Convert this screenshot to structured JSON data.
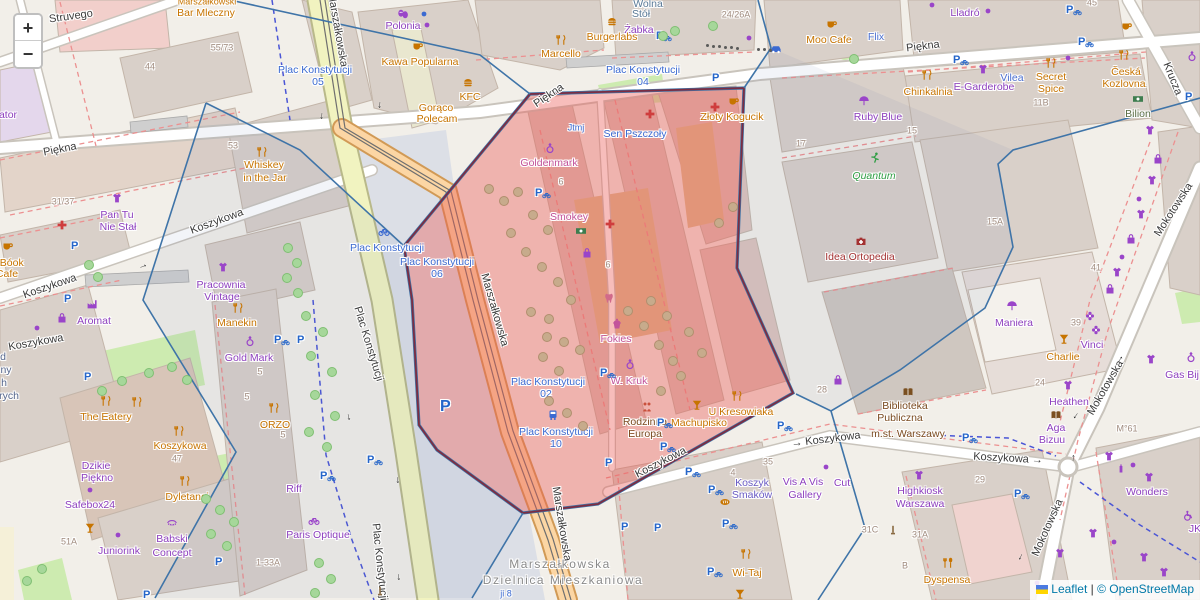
{
  "controls": {
    "zoom_in": "+",
    "zoom_out": "−"
  },
  "attribution": {
    "leaflet": "Leaflet",
    "separator": " | ",
    "osm": "© OpenStreetMap"
  },
  "colors": {
    "overlay": "#ea5a56",
    "overlay_border": "#7c2d42",
    "boundary": "#3f74a8",
    "parking_blue": "#2565c9",
    "poi_orange": "#c77400",
    "poi_purple": "#9a45c9",
    "transit_blue": "#3b6ad1",
    "link_blue": "#0078A8"
  },
  "district": [
    [
      "Marszałkowska",
      560,
      564
    ],
    [
      "Dzielnica Mieszkaniowa",
      563,
      580
    ]
  ],
  "streets": [
    [
      "Struvego",
      71,
      17,
      -8
    ],
    [
      "Piękna",
      60,
      150,
      -11
    ],
    [
      "Piękna",
      549,
      96,
      -34
    ],
    [
      "Piękna",
      923,
      47,
      -7
    ],
    [
      "Marszałkowska",
      337,
      30,
      80
    ],
    [
      "Marszałkowska",
      494,
      310,
      74
    ],
    [
      "Marszałkowska",
      561,
      524,
      81
    ],
    [
      "Plac Konstytucji",
      368,
      344,
      73
    ],
    [
      "Plac Konstytucji",
      379,
      562,
      84
    ],
    [
      "Koszykowa",
      50,
      287,
      -19
    ],
    [
      "Koszykowa",
      217,
      222,
      -20
    ],
    [
      "Koszykowa",
      36,
      343,
      -10
    ],
    [
      "Koszykowa",
      661,
      463,
      -27
    ],
    [
      "→ Koszykowa",
      826,
      440,
      -7
    ],
    [
      "Koszykowa →",
      1008,
      459,
      3
    ],
    [
      "Mokotowska",
      1174,
      210,
      -57
    ],
    [
      "Mokotowska",
      1106,
      388,
      -60
    ],
    [
      "Mokotowska",
      1048,
      528,
      -66
    ],
    [
      "Krucza",
      1172,
      79,
      68
    ]
  ],
  "transit": [
    [
      "Plac Konstytucji",
      315,
      70
    ],
    [
      "05",
      318,
      82
    ],
    [
      "Plac Konstytucji",
      643,
      70
    ],
    [
      "04",
      643,
      82
    ],
    [
      "Plac Konstytucji",
      387,
      248
    ],
    [
      "Plac Konstytucji",
      437,
      262
    ],
    [
      "06",
      437,
      274
    ],
    [
      "Plac Konstytucji",
      548,
      382
    ],
    [
      "02",
      546,
      394
    ],
    [
      "Plac Konstytucji",
      556,
      432
    ],
    [
      "10",
      556,
      444
    ],
    [
      "Sen Pszczoły",
      635,
      134
    ],
    [
      "Jtmj",
      576,
      128,
      9
    ],
    [
      "ji 8",
      506,
      594,
      9
    ]
  ],
  "pois": [
    [
      "Marszałkowski",
      207,
      2,
      "o",
      9
    ],
    [
      "Bar Mleczny",
      206,
      13,
      "o"
    ],
    [
      "Polonia",
      403,
      26,
      "p"
    ],
    [
      "Żabka",
      639,
      30,
      "p"
    ],
    [
      "Burgerlabs",
      612,
      37,
      "o"
    ],
    [
      "Wolna",
      648,
      4,
      "bg"
    ],
    [
      "Stół",
      641,
      14,
      "bg"
    ],
    [
      "Kawa Popularna",
      420,
      62,
      "o"
    ],
    [
      "KFC",
      470,
      97,
      "o"
    ],
    [
      "Gorąco",
      436,
      108,
      "o"
    ],
    [
      "Polecam",
      437,
      119,
      "o"
    ],
    [
      "Marcello",
      561,
      54,
      "o"
    ],
    [
      "Moo Cafe",
      829,
      40,
      "o"
    ],
    [
      "Flix",
      876,
      37,
      "b"
    ],
    [
      "Lladró",
      965,
      13,
      "p"
    ],
    [
      "Ruby Blue",
      878,
      117,
      "p"
    ],
    [
      "Chinkalnia",
      928,
      92,
      "o"
    ],
    [
      "E-Garderobe",
      984,
      87,
      "p"
    ],
    [
      "Vilea",
      1012,
      78,
      "b"
    ],
    [
      "Secret",
      1051,
      77,
      "o"
    ],
    [
      "Spice",
      1051,
      89,
      "o"
    ],
    [
      "Česká",
      1126,
      72,
      "o"
    ],
    [
      "Kozlovna",
      1124,
      84,
      "o"
    ],
    [
      "Bilion",
      1138,
      114,
      "ol"
    ],
    [
      "Whiskey",
      264,
      165,
      "o"
    ],
    [
      "in the Jar",
      265,
      178,
      "o"
    ],
    [
      "Pan Tu",
      117,
      215,
      "p"
    ],
    [
      "Nie Stał",
      118,
      227,
      "p"
    ],
    [
      "Pracownia",
      221,
      285,
      "p"
    ],
    [
      "Vintage",
      222,
      297,
      "p"
    ],
    [
      "-Bóok",
      10,
      263,
      "o"
    ],
    [
      "Cafe",
      7,
      274,
      "o"
    ],
    [
      "Aromat",
      94,
      321,
      "p"
    ],
    [
      "Manekin",
      237,
      323,
      "o"
    ],
    [
      "Gold Mark",
      249,
      358,
      "p"
    ],
    [
      "ORZO",
      275,
      425,
      "o"
    ],
    [
      "The Eatery",
      106,
      417,
      "o"
    ],
    [
      "Koszykowa",
      180,
      446,
      "o"
    ],
    [
      "Dzikie",
      96,
      466,
      "p"
    ],
    [
      "Piękno",
      97,
      478,
      "p"
    ],
    [
      "Safebox24",
      90,
      505,
      "p"
    ],
    [
      "Dyletanci",
      187,
      497,
      "o"
    ],
    [
      "Babski",
      172,
      539,
      "p"
    ],
    [
      "Concept",
      172,
      553,
      "p"
    ],
    [
      "Juniorink",
      119,
      551,
      "p"
    ],
    [
      "Riff",
      294,
      489,
      "p"
    ],
    [
      "Paris Optique",
      318,
      535,
      "p"
    ],
    [
      "Goldenmark",
      549,
      163,
      "k"
    ],
    [
      "Smokey",
      569,
      217,
      "k"
    ],
    [
      "Złoty Kogucik",
      732,
      117,
      "o"
    ],
    [
      "Fokies",
      616,
      339,
      "k"
    ],
    [
      "W. Kruk",
      629,
      381,
      "k"
    ],
    [
      "Rodzinna",
      645,
      422,
      "br"
    ],
    [
      "Europa",
      645,
      434,
      "br"
    ],
    [
      "Machupisko",
      699,
      423,
      "o"
    ],
    [
      "U Kresowiaka",
      741,
      412,
      "o"
    ],
    [
      "Quantum",
      874,
      176,
      "g"
    ],
    [
      "Idea Ortopedia",
      860,
      257,
      "dr"
    ],
    [
      "Maniera",
      1014,
      323,
      "p"
    ],
    [
      "Vinci",
      1092,
      345,
      "p"
    ],
    [
      "Charlie",
      1063,
      357,
      "o"
    ],
    [
      "Heathen",
      1069,
      402,
      "p"
    ],
    [
      "Aga",
      1056,
      428,
      "p"
    ],
    [
      "Bizuu",
      1052,
      440,
      "p"
    ],
    [
      "Gas Bij",
      1182,
      375,
      "p"
    ],
    [
      "Biblioteka",
      905,
      406,
      "br"
    ],
    [
      "Publiczna",
      900,
      418,
      "br"
    ],
    [
      "m.st. Warszawy",
      908,
      434,
      "br"
    ],
    [
      "Highkiosk",
      920,
      491,
      "p"
    ],
    [
      "Warszawa",
      920,
      504,
      "p"
    ],
    [
      "Wonders",
      1147,
      492,
      "p"
    ],
    [
      "Dyspensa",
      947,
      580,
      "o"
    ],
    [
      "Wi-Taj",
      747,
      573,
      "o"
    ],
    [
      "Koszyk",
      752,
      483,
      "vb"
    ],
    [
      "Smaków",
      752,
      495,
      "vb"
    ],
    [
      "Vis A Vis",
      803,
      482,
      "p"
    ],
    [
      "Gallery",
      805,
      495,
      "p"
    ],
    [
      "Cut",
      842,
      483,
      "p"
    ],
    [
      "ator",
      8,
      115,
      "p"
    ],
    [
      "d",
      3,
      357,
      "b2"
    ],
    [
      "ny",
      6,
      370,
      "b2"
    ],
    [
      "h",
      4,
      383,
      "b2"
    ],
    [
      "rych",
      9,
      396,
      "b2"
    ],
    [
      "JK",
      1195,
      529,
      "p"
    ]
  ],
  "housenumbers": [
    [
      "44",
      150,
      67
    ],
    [
      "55/73",
      222,
      48
    ],
    [
      "53",
      233,
      146
    ],
    [
      "31/37",
      63,
      202
    ],
    [
      "24/26A",
      736,
      15
    ],
    [
      "17",
      801,
      144
    ],
    [
      "15",
      912,
      131
    ],
    [
      "11B",
      1041,
      103
    ],
    [
      "15A",
      995,
      222
    ],
    [
      "41",
      1096,
      268
    ],
    [
      "45",
      1092,
      3
    ],
    [
      "39",
      1076,
      323
    ],
    [
      "24",
      1040,
      383
    ],
    [
      "28",
      822,
      390
    ],
    [
      "6",
      561,
      182
    ],
    [
      "6",
      608,
      265
    ],
    [
      "5",
      260,
      372
    ],
    [
      "5",
      247,
      397
    ],
    [
      "5",
      283,
      435
    ],
    [
      "47",
      177,
      459
    ],
    [
      "51A",
      69,
      542
    ],
    [
      "1-33A",
      268,
      563
    ],
    [
      "29",
      980,
      480
    ],
    [
      "31A",
      920,
      535
    ],
    [
      "31C",
      870,
      530
    ],
    [
      "35",
      768,
      462
    ],
    [
      "4",
      733,
      473
    ],
    [
      "B",
      905,
      566
    ],
    [
      "M°61",
      1127,
      429
    ]
  ],
  "icons": [
    [
      "cup",
      418,
      46
    ],
    [
      "cup",
      8,
      246
    ],
    [
      "cup",
      734,
      101
    ],
    [
      "cup",
      832,
      24
    ],
    [
      "cup",
      1127,
      26
    ],
    [
      "burger",
      612,
      22
    ],
    [
      "burger",
      468,
      83
    ],
    [
      "fork",
      561,
      40
    ],
    [
      "fork",
      262,
      152
    ],
    [
      "fork",
      238,
      308
    ],
    [
      "fork",
      274,
      408
    ],
    [
      "fork",
      106,
      401
    ],
    [
      "fork",
      137,
      402
    ],
    [
      "fork",
      179,
      431
    ],
    [
      "fork",
      185,
      481
    ],
    [
      "fork",
      927,
      75
    ],
    [
      "fork",
      1051,
      63
    ],
    [
      "fork",
      1124,
      55
    ],
    [
      "fork",
      737,
      396
    ],
    [
      "fork",
      746,
      554
    ],
    [
      "forkspoon",
      948,
      563
    ],
    [
      "cocktail",
      90,
      528
    ],
    [
      "cocktail",
      1064,
      339
    ],
    [
      "cocktail",
      697,
      405
    ],
    [
      "cocktail",
      740,
      594
    ],
    [
      "ring",
      250,
      341
    ],
    [
      "ring",
      550,
      148
    ],
    [
      "ring",
      630,
      364
    ],
    [
      "ring",
      1191,
      357
    ],
    [
      "ring",
      1192,
      56
    ],
    [
      "cross",
      62,
      225
    ],
    [
      "cross",
      650,
      114
    ],
    [
      "cross",
      715,
      107
    ],
    [
      "cross",
      610,
      224
    ],
    [
      "case",
      861,
      241
    ],
    [
      "tooth",
      609,
      298
    ],
    [
      "book",
      908,
      392
    ],
    [
      "book",
      1056,
      415
    ],
    [
      "money",
      581,
      231
    ],
    [
      "money",
      1138,
      99
    ],
    [
      "runner",
      875,
      158
    ],
    [
      "people",
      647,
      407
    ],
    [
      "umbrella",
      864,
      101
    ],
    [
      "umbrella",
      1012,
      306
    ],
    [
      "bag",
      62,
      318
    ],
    [
      "bag",
      587,
      253
    ],
    [
      "bag",
      838,
      380
    ],
    [
      "bag",
      1158,
      159
    ],
    [
      "bag",
      1131,
      239
    ],
    [
      "bag",
      1110,
      289
    ],
    [
      "cake",
      617,
      324
    ],
    [
      "masks",
      403,
      14
    ],
    [
      "car",
      776,
      49
    ],
    [
      "tram",
      553,
      415
    ],
    [
      "dot",
      427,
      25
    ],
    [
      "dot",
      932,
      5
    ],
    [
      "dot",
      988,
      11
    ],
    [
      "dot",
      1068,
      58
    ],
    [
      "dot",
      37,
      328
    ],
    [
      "dot",
      118,
      535
    ],
    [
      "dot",
      90,
      490
    ],
    [
      "dot",
      1139,
      199
    ],
    [
      "dot",
      1122,
      257
    ],
    [
      "dot",
      1133,
      465
    ],
    [
      "dot",
      1114,
      542
    ],
    [
      "dot",
      1037,
      583
    ],
    [
      "dot",
      826,
      467
    ],
    [
      "dot",
      749,
      38
    ],
    [
      "dot",
      424,
      14,
      "#3b6ad1"
    ],
    [
      "flower",
      1090,
      316
    ],
    [
      "flower",
      1096,
      330
    ],
    [
      "bottle",
      1121,
      468
    ],
    [
      "wheelchair",
      1188,
      516
    ],
    [
      "factory",
      92,
      304
    ],
    [
      "pole",
      380,
      591
    ],
    [
      "pole",
      893,
      530
    ],
    [
      "bike",
      384,
      231
    ],
    [
      "bike",
      314,
      520,
      "#9a45c9"
    ],
    [
      "bread",
      725,
      502
    ],
    [
      "shirt",
      117,
      198
    ],
    [
      "shirt",
      223,
      267
    ],
    [
      "shirt",
      983,
      69
    ],
    [
      "shirt",
      919,
      475
    ],
    [
      "shirt",
      1068,
      385
    ],
    [
      "shirt",
      1151,
      359
    ],
    [
      "shirt",
      1152,
      180
    ],
    [
      "shirt",
      1141,
      214
    ],
    [
      "shirt",
      1117,
      272
    ],
    [
      "shirt",
      1109,
      456
    ],
    [
      "shirt",
      1149,
      477
    ],
    [
      "shirt",
      1093,
      533
    ],
    [
      "shirt",
      1144,
      557
    ],
    [
      "shirt",
      1164,
      572
    ],
    [
      "shirt",
      1060,
      553
    ],
    [
      "shirt",
      1150,
      130
    ],
    [
      "lash",
      172,
      522
    ]
  ],
  "parking": [
    [
      71,
      246,
      0
    ],
    [
      64,
      299,
      0
    ],
    [
      297,
      340,
      0
    ],
    [
      274,
      340,
      1
    ],
    [
      84,
      377,
      0
    ],
    [
      440,
      404,
      2
    ],
    [
      535,
      193,
      1
    ],
    [
      656,
      36,
      1
    ],
    [
      712,
      78,
      0
    ],
    [
      953,
      60,
      1
    ],
    [
      1066,
      10,
      1
    ],
    [
      1078,
      42,
      1
    ],
    [
      1185,
      97,
      0
    ],
    [
      600,
      373,
      1
    ],
    [
      657,
      423,
      1
    ],
    [
      660,
      447,
      1
    ],
    [
      777,
      426,
      1
    ],
    [
      605,
      463,
      0
    ],
    [
      685,
      472,
      1
    ],
    [
      708,
      490,
      1
    ],
    [
      722,
      524,
      1
    ],
    [
      707,
      572,
      1
    ],
    [
      621,
      527,
      0
    ],
    [
      654,
      528,
      0
    ],
    [
      1014,
      494,
      1
    ],
    [
      962,
      438,
      1
    ],
    [
      367,
      460,
      1
    ],
    [
      320,
      476,
      1
    ],
    [
      215,
      562,
      0
    ],
    [
      143,
      595,
      0
    ]
  ],
  "arrows": [
    [
      322,
      116,
      95
    ],
    [
      380,
      105,
      95
    ],
    [
      143,
      266,
      -22
    ],
    [
      349,
      417,
      78
    ],
    [
      398,
      480,
      85
    ],
    [
      399,
      577,
      85
    ],
    [
      1120,
      359,
      -55
    ],
    [
      1076,
      416,
      125
    ],
    [
      1073,
      458,
      -85
    ],
    [
      1021,
      557,
      115
    ]
  ],
  "trees_green": [
    [
      287,
      247
    ],
    [
      296,
      262
    ],
    [
      286,
      277
    ],
    [
      297,
      292
    ],
    [
      305,
      315
    ],
    [
      322,
      331
    ],
    [
      310,
      355
    ],
    [
      331,
      371
    ],
    [
      314,
      394
    ],
    [
      334,
      415
    ],
    [
      308,
      431
    ],
    [
      326,
      446
    ],
    [
      88,
      264
    ],
    [
      97,
      276
    ],
    [
      121,
      380
    ],
    [
      101,
      390
    ],
    [
      148,
      372
    ],
    [
      171,
      366
    ],
    [
      186,
      379
    ],
    [
      318,
      562
    ],
    [
      330,
      578
    ],
    [
      314,
      592
    ],
    [
      205,
      498
    ],
    [
      219,
      509
    ],
    [
      233,
      521
    ],
    [
      210,
      533
    ],
    [
      226,
      545
    ],
    [
      662,
      35
    ],
    [
      674,
      30
    ],
    [
      712,
      25
    ],
    [
      853,
      58
    ],
    [
      26,
      580
    ],
    [
      41,
      568
    ]
  ],
  "trees_brown": [
    [
      488,
      188
    ],
    [
      503,
      200
    ],
    [
      517,
      191
    ],
    [
      532,
      214
    ],
    [
      547,
      229
    ],
    [
      510,
      232
    ],
    [
      525,
      251
    ],
    [
      541,
      266
    ],
    [
      557,
      281
    ],
    [
      570,
      299
    ],
    [
      530,
      311
    ],
    [
      548,
      318
    ],
    [
      546,
      336
    ],
    [
      563,
      341
    ],
    [
      579,
      349
    ],
    [
      542,
      356
    ],
    [
      558,
      370
    ],
    [
      548,
      400
    ],
    [
      566,
      412
    ],
    [
      582,
      425
    ],
    [
      627,
      310
    ],
    [
      643,
      325
    ],
    [
      658,
      344
    ],
    [
      672,
      360
    ],
    [
      650,
      300
    ],
    [
      666,
      315
    ],
    [
      688,
      331
    ],
    [
      701,
      352
    ],
    [
      680,
      375
    ],
    [
      660,
      390
    ],
    [
      732,
      206
    ],
    [
      718,
      222
    ]
  ],
  "bollards": [
    [
      706,
      44
    ],
    [
      712,
      45
    ],
    [
      718,
      45
    ],
    [
      724,
      46
    ],
    [
      730,
      46
    ],
    [
      736,
      47
    ],
    [
      757,
      48
    ],
    [
      763,
      48
    ],
    [
      769,
      49
    ]
  ]
}
